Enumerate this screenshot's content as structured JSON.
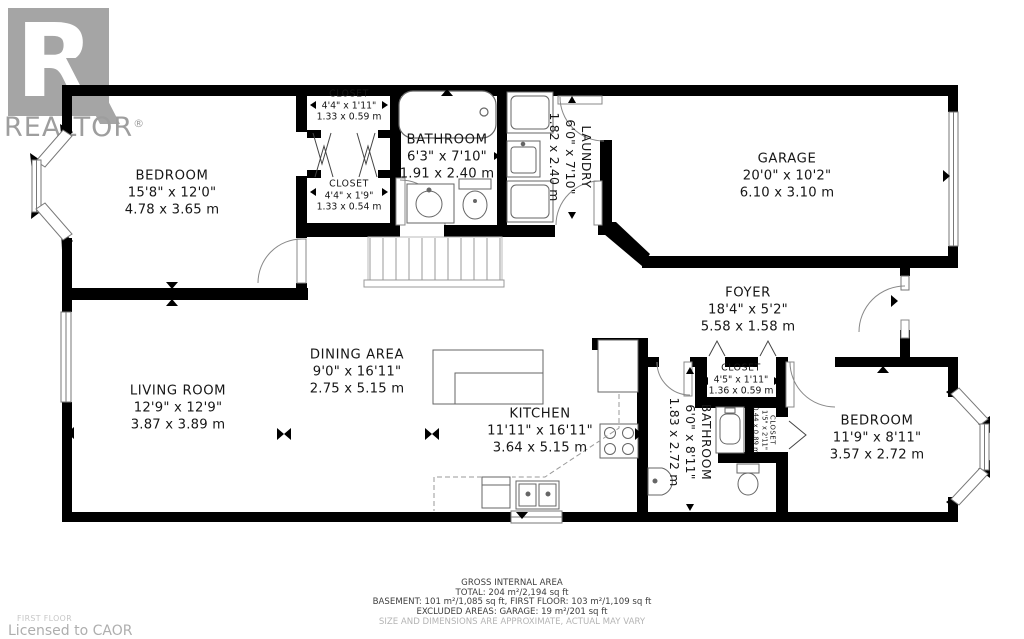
{
  "watermark": {
    "logo_letter": "R",
    "brand": "REALTOR",
    "registered": "®"
  },
  "rooms": {
    "bedroom1": {
      "name": "BEDROOM",
      "imperial": "15'8\" x 12'0\"",
      "metric": "4.78 x 3.65 m"
    },
    "closet1": {
      "name": "CLOSET",
      "imperial": "4'4\" x 1'11\"",
      "metric": "1.33 x 0.59 m"
    },
    "closet2": {
      "name": "CLOSET",
      "imperial": "4'4\" x 1'9\"",
      "metric": "1.33 x 0.54 m"
    },
    "bathroom1": {
      "name": "BATHROOM",
      "imperial": "6'3\" x 7'10\"",
      "metric": "1.91 x 2.40 m"
    },
    "laundry": {
      "name": "LAUNDRY",
      "imperial": "6'0\" x 7'10\"",
      "metric": "1.82 x 2.40 m"
    },
    "garage": {
      "name": "GARAGE",
      "imperial": "20'0\" x 10'2\"",
      "metric": "6.10 x 3.10 m"
    },
    "foyer": {
      "name": "FOYER",
      "imperial": "18'4\" x 5'2\"",
      "metric": "5.58 x 1.58 m"
    },
    "living": {
      "name": "LIVING ROOM",
      "imperial": "12'9\" x 12'9\"",
      "metric": "3.87 x 3.89 m"
    },
    "dining": {
      "name": "DINING AREA",
      "imperial": "9'0\" x 16'11\"",
      "metric": "2.75 x 5.15 m"
    },
    "kitchen": {
      "name": "KITCHEN",
      "imperial": "11'11\" x 16'11\"",
      "metric": "3.64 x 5.15 m"
    },
    "closet3": {
      "name": "CLOSET",
      "imperial": "4'5\" x 1'11\"",
      "metric": "1.36 x 0.59 m"
    },
    "bathroom2": {
      "name": "BATHROOM",
      "imperial": "6'0\" x 8'11\"",
      "metric": "1.83 x 2.72 m"
    },
    "closet4": {
      "name": "CLOSET",
      "imperial": "1'5\" x 2'11\"",
      "metric": "0.44 x 0.89 m"
    },
    "bedroom2": {
      "name": "BEDROOM",
      "imperial": "11'9\" x 8'11\"",
      "metric": "3.57 x 2.72 m"
    }
  },
  "footer": {
    "title": "GROSS INTERNAL AREA",
    "total": "TOTAL: 204 m²/2,194 sq ft",
    "breakdown": "BASEMENT: 101 m²/1,085 sq ft, FIRST FLOOR: 103 m²/1,109 sq ft",
    "excluded": "EXCLUDED AREAS: GARAGE: 19 m²/201 sq ft",
    "disclaimer": "SIZE AND DIMENSIONS ARE APPROXIMATE, ACTUAL MAY VARY"
  },
  "corner": {
    "floor_label": "FIRST FLOOR",
    "license": "Licensed to CAOR"
  },
  "colors": {
    "wall": "#000000",
    "watermark": "#a5a5a5",
    "fixture": "#666666",
    "disclaimer": "#b4b4b4"
  }
}
